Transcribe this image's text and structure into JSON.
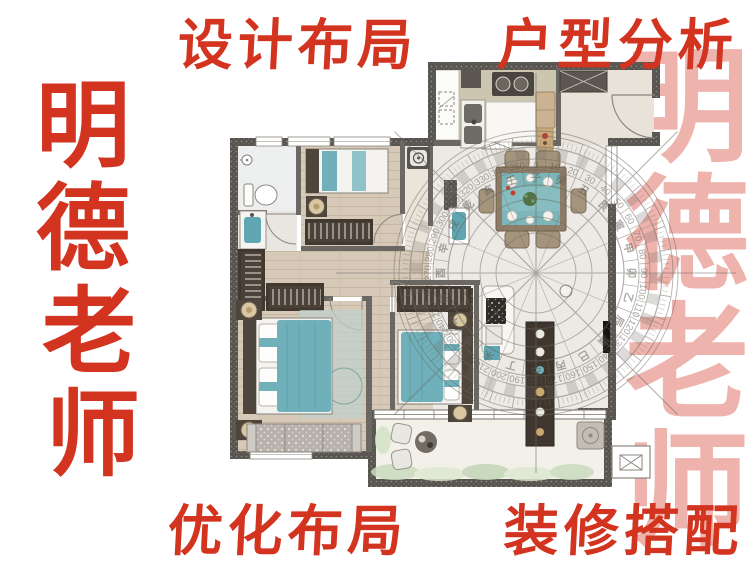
{
  "poster": {
    "top_title": {
      "part1": "设计布局",
      "part2": "户型分析"
    },
    "bottom_title": {
      "part1": "优化布局",
      "part2": "装修搭配"
    },
    "left_brand_vertical": "明德老师",
    "right_watermark_vertical": "明德老师"
  },
  "colors": {
    "calligraphy_red": "#d23420",
    "watermark_pink": "#dd6a5c",
    "wall_dark": "#57534e",
    "bed_teal": "#6fb0ba",
    "wood_floor": "#d6c9b8",
    "compass_line": "#6e6961"
  },
  "compass": {
    "degree_step": 10,
    "degree_labels": [
      "0",
      "10",
      "20",
      "30",
      "40",
      "50",
      "60",
      "70",
      "80",
      "90",
      "100",
      "110",
      "120",
      "130",
      "140",
      "150",
      "160",
      "170",
      "180",
      "190",
      "200",
      "210",
      "220",
      "230",
      "240",
      "250",
      "260",
      "270",
      "280",
      "290",
      "300",
      "310",
      "320",
      "330",
      "340",
      "350"
    ],
    "mountain_chars": [
      "子",
      "癸",
      "丑",
      "艮",
      "寅",
      "甲",
      "卯",
      "乙",
      "辰",
      "巽",
      "巳",
      "丙",
      "午",
      "丁",
      "未",
      "坤",
      "申",
      "庚",
      "酉",
      "辛",
      "戌",
      "乾",
      "亥",
      "壬"
    ]
  }
}
